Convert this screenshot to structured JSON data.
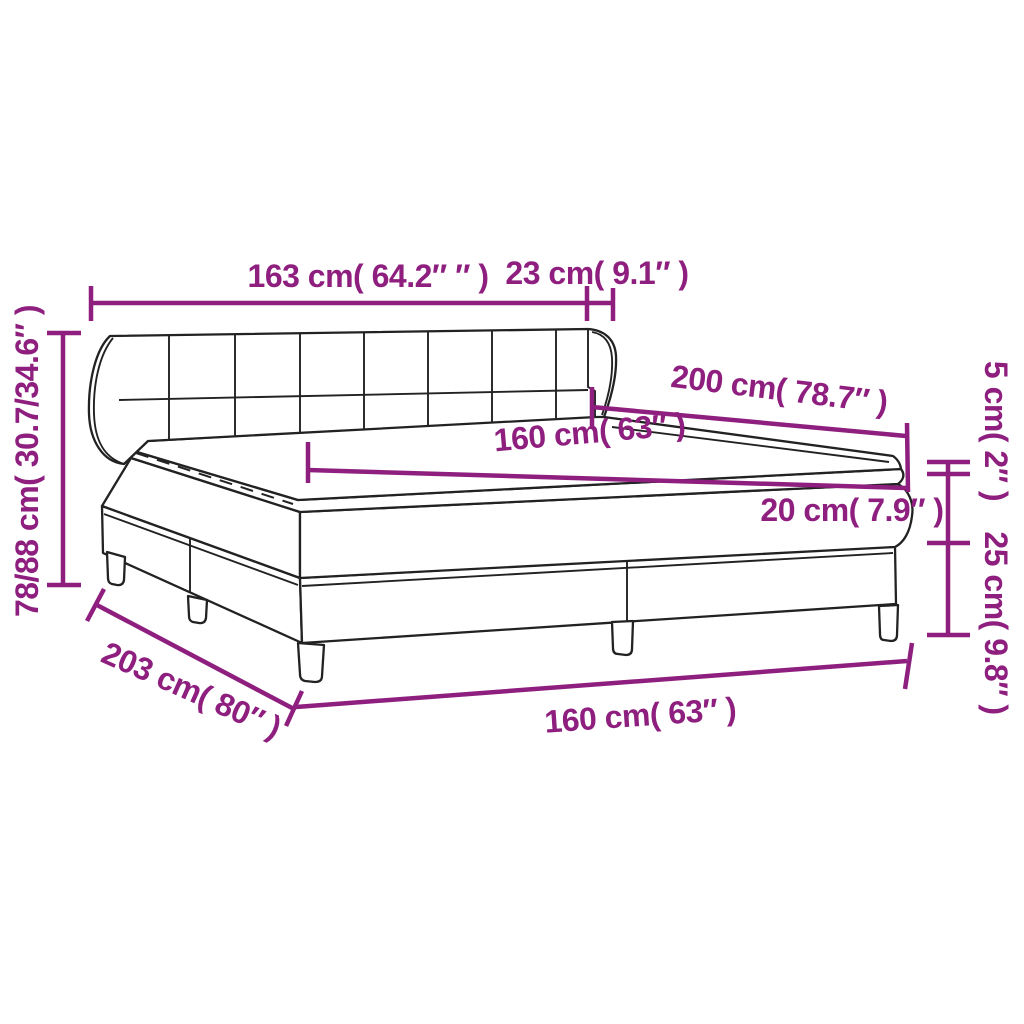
{
  "diagram": {
    "product": "box-spring-bed-with-tufted-headboard",
    "background": "#ffffff",
    "accent_color": "#8e1f7f",
    "outline_color": "#222222",
    "dimensions": {
      "headboard_width": "163 cm( 64.2″ ″ )",
      "headboard_side_depth": "23 cm( 9.1″ )",
      "bed_length": "200 cm( 78.7″ )",
      "mattress_width_top": "160 cm( 63″ )",
      "topper_thickness": "5 cm( 2″ )",
      "mattress_thickness": "20 cm( 7.9″ )",
      "base_height": "25 cm( 9.8″ )",
      "overall_height": "78/88 cm( 30.7/34.6″ )",
      "overall_length": "203 cm( 80″ )",
      "mattress_width_bottom": "160 cm( 63″ )"
    }
  }
}
